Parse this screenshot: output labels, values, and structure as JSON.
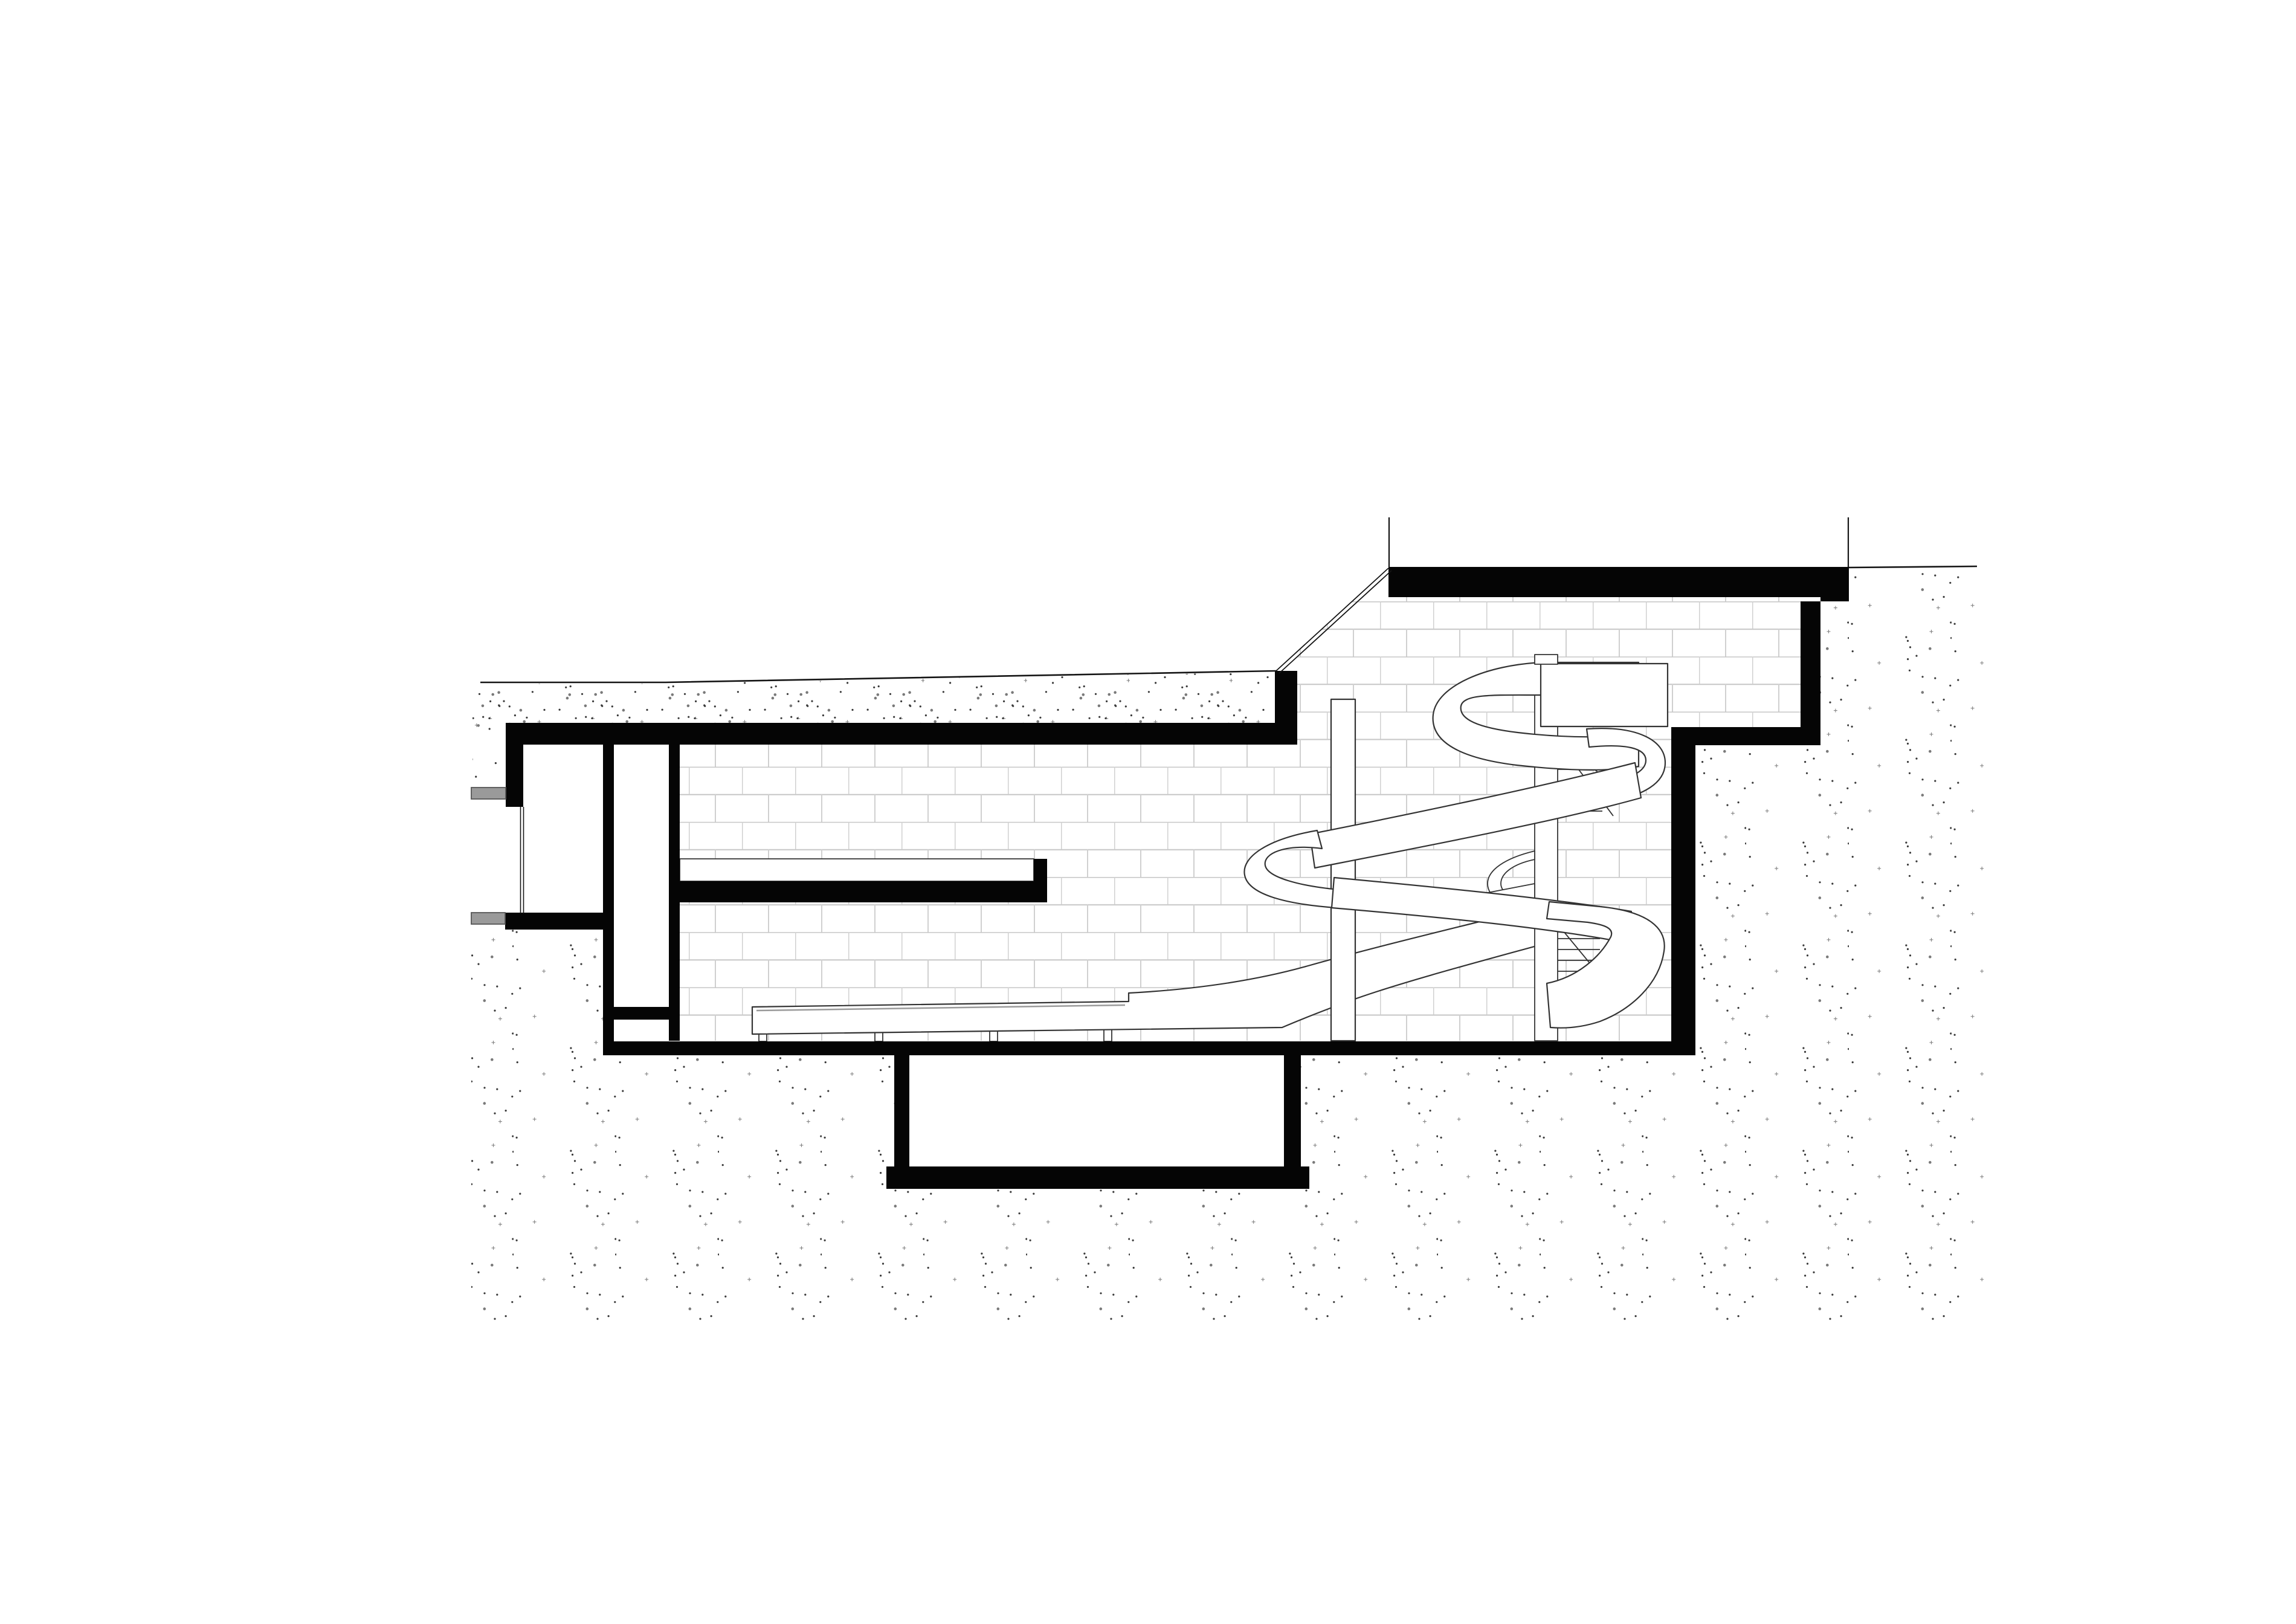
{
  "meta": {
    "kind": "architectural-section-drawing",
    "subject": "indoor hall cross-section with spiral waterslide, spiral stair, under-floor basin and earth hatching",
    "visible_text": []
  },
  "palette": {
    "background": "#ffffff",
    "ink": "#050505",
    "line": "#141414",
    "brick_joint": "#cbcbcb",
    "slide_outline": "#333333",
    "pipe_fill": "#9a9a9a",
    "pipe_edge": "#555555",
    "stipple_dark": "#3a3a3a",
    "stipple_light": "#7a7a7a"
  },
  "stipple": {
    "tile": 170,
    "sparse_dots": 22,
    "dense_dots": 46,
    "seed": 7
  },
  "elements": {
    "ground_line": "sloping grade line",
    "glazing": "double-line sloped clerestory between roof levels",
    "left_pipes": "two grey service pipes entering left wall",
    "wall_pattern": "running-bond block joints",
    "waterslide": "helical flume with straight run-out trough on legs",
    "stair": "spiral stair with centre pole and treads",
    "platform": "slide start platform box",
    "basin": "under-floor basin with deep pit"
  }
}
